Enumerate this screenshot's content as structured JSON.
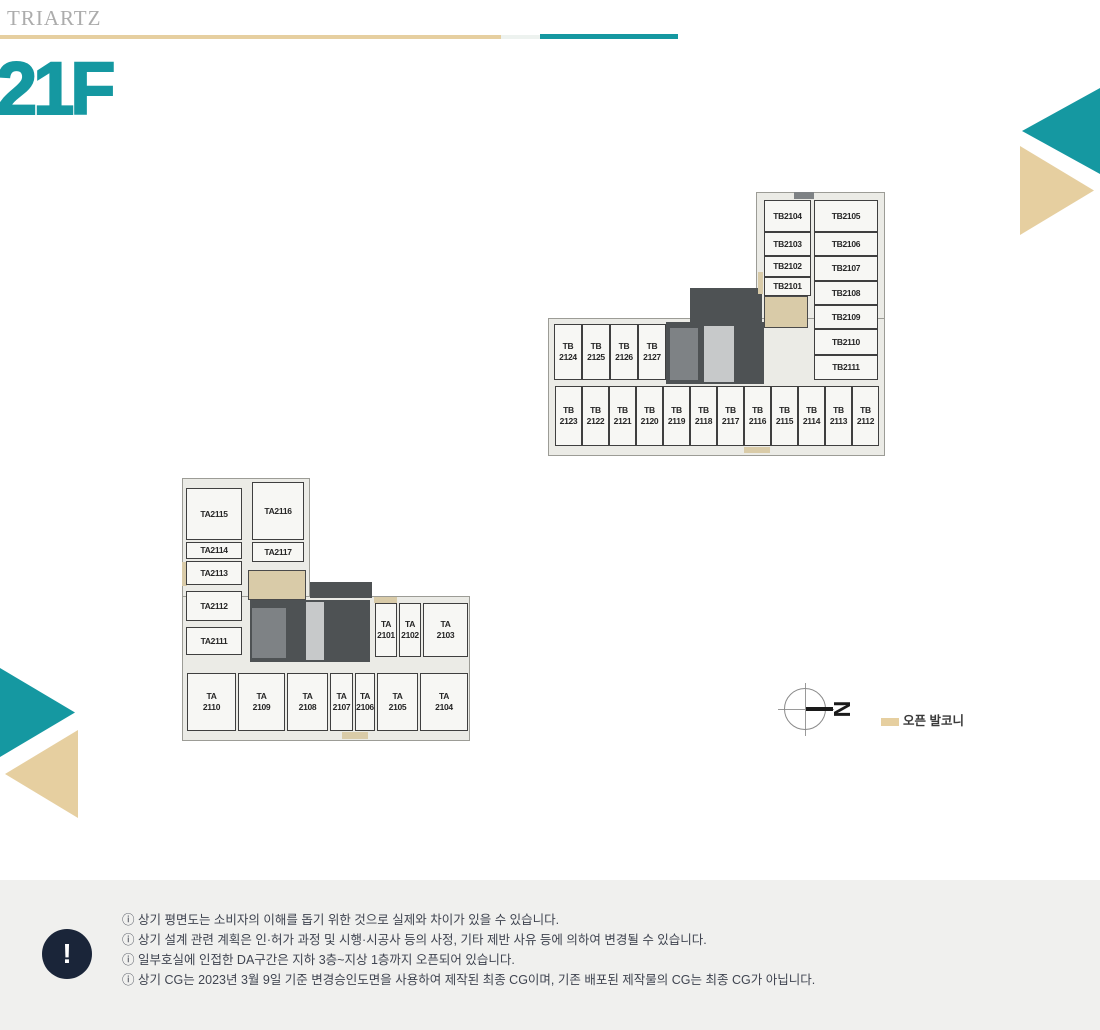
{
  "colors": {
    "teal": "#1598A1",
    "beige": "#E6CFA0",
    "navy": "#1A2539",
    "footer_bg": "#F0F0EE"
  },
  "header": {
    "logo": "TRIARTZ",
    "floor": "21F"
  },
  "plans": {
    "tb": {
      "col_a": [
        "TB2104",
        "TB2103",
        "TB2102",
        "TB2101"
      ],
      "col_b": [
        "TB2105",
        "TB2106",
        "TB2107",
        "TB2108",
        "TB2109",
        "TB2110",
        "TB2111"
      ],
      "left_row": [
        "TB 2124",
        "TB 2125",
        "TB 2126",
        "TB 2127"
      ],
      "bottom_row": [
        "TB 2123",
        "TB 2122",
        "TB 2121",
        "TB 2120",
        "TB 2119",
        "TB 2118",
        "TB 2117",
        "TB 2116",
        "TB 2115",
        "TB 2114",
        "TB 2113",
        "TB 2112"
      ]
    },
    "ta": {
      "left_col": [
        "TA2115",
        "TA2114",
        "TA2113",
        "TA2112",
        "TA2111"
      ],
      "col2": [
        "TA2116",
        "TA2117"
      ],
      "mid_row": [
        "TA 2101",
        "TA 2102",
        "TA 2103"
      ],
      "bottom_row": [
        "TA 2110",
        "TA 2109",
        "TA 2108",
        "TA 2107",
        "TA 2106",
        "TA 2105",
        "TA 2104"
      ]
    }
  },
  "compass": {
    "north_letter": "N"
  },
  "legend": {
    "open_balcony": "오픈 발코니"
  },
  "notices": {
    "icon": "!",
    "items": [
      "ⓘ 상기 평면도는 소비자의 이해를 돕기 위한 것으로 실제와 차이가 있을 수 있습니다.",
      "ⓘ 상기 설계 관련 계획은 인·허가 과정 및 시행·시공사 등의 사정, 기타 제반 사유 등에 의하여 변경될 수 있습니다.",
      "ⓘ 일부호실에 인접한 DA구간은 지하 3층~지상 1층까지 오픈되어 있습니다.",
      "ⓘ 상기 CG는 2023년 3월 9일 기준 변경승인도면을 사용하여 제작된 최종 CG이며, 기존 배포된 제작물의 CG는 최종 CG가 아닙니다."
    ]
  }
}
